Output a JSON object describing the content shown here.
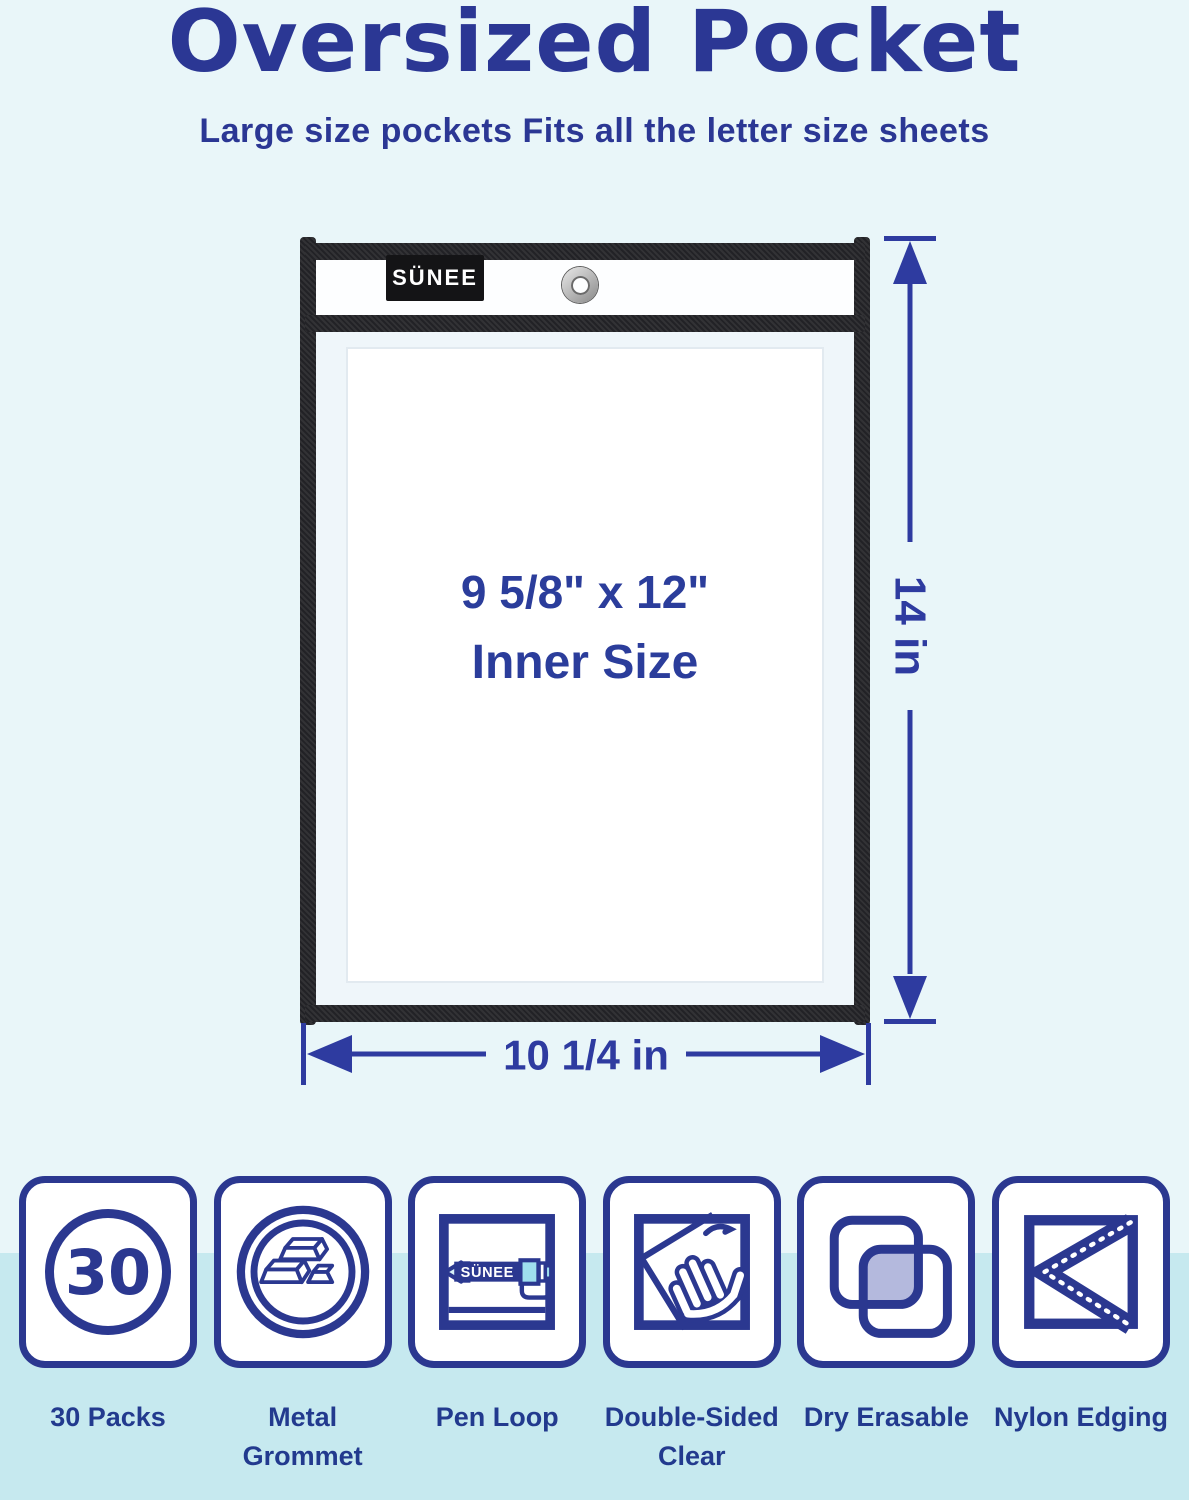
{
  "page": {
    "title": "Oversized Pocket",
    "subtitle": "Large size pockets Fits all the letter size sheets"
  },
  "pocket": {
    "brand": "SÜNEE",
    "inner_size": "9 5/8\" x 12\"",
    "inner_size_caption": "Inner Size",
    "height_label": "14 in",
    "width_label": "10 1/4 in"
  },
  "features": [
    {
      "icon": "pack-count-icon",
      "badge": "30",
      "label": "30 Packs"
    },
    {
      "icon": "metal-grommet-icon",
      "label": "Metal Grommet"
    },
    {
      "icon": "pen-loop-icon",
      "pen_text": "SÜNEE",
      "label": "Pen Loop"
    },
    {
      "icon": "double-sided-clear-icon",
      "label": "Double-Sided Clear"
    },
    {
      "icon": "dry-erasable-icon",
      "label": "Dry Erasable"
    },
    {
      "icon": "nylon-edging-icon",
      "label": "Nylon Edging"
    }
  ],
  "colors": {
    "accent_navy": "#2b3794",
    "icon_navy": "#2b3890",
    "dimension_blue": "#2e3ba0",
    "background_top": "#e9f6f9",
    "background_strip": "#c6e9ef",
    "edging_black": "#222226",
    "lavender_fill": "#b4b9dd",
    "pen_cyan": "#9fdfee"
  }
}
